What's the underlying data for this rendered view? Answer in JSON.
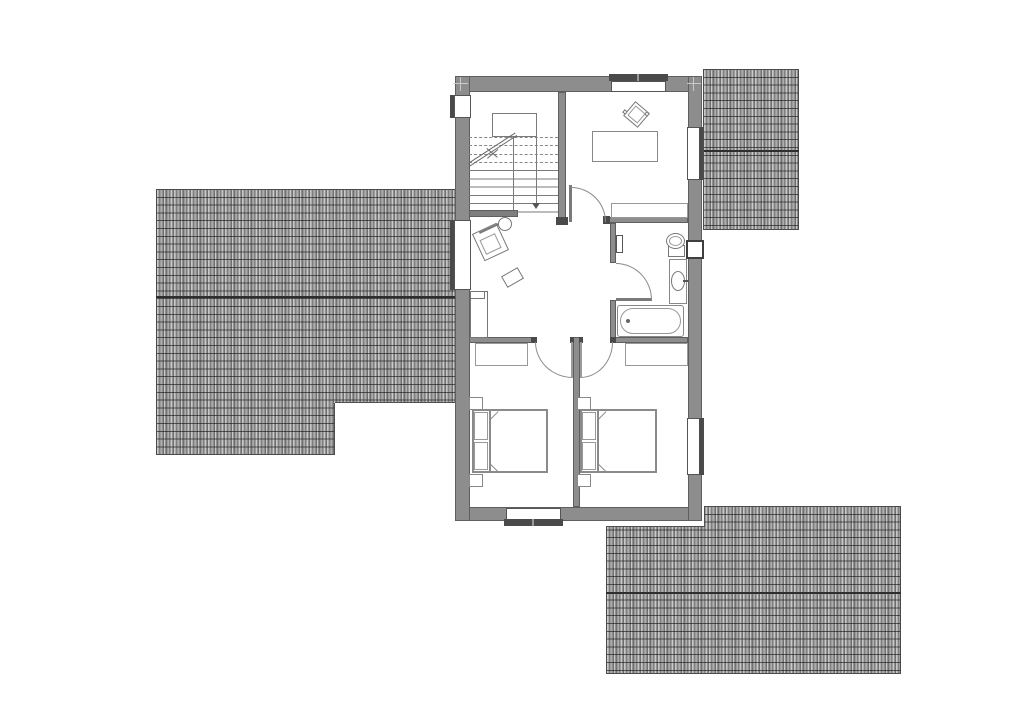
{
  "canvas": {
    "width": 1024,
    "height": 714
  },
  "colors": {
    "background": "#ffffff",
    "wall_fill": "#8d8d8d",
    "wall_edge": "#5f5f5f",
    "jamb_dark": "#4a4a4a",
    "furniture_line": "#7a7a7a",
    "roof_tile_dark": "#6f6f6f",
    "roof_tile_light": "#c9c9c9",
    "roof_ridge": "#2e2e2e"
  },
  "roofs": [
    {
      "n": "roof-left",
      "x": 156,
      "y": 189,
      "w": 300,
      "h": 266,
      "ridge": 107,
      "clip": "0px 0px, 300px 0px, 300px 214px, 179px 214px, 179px 266px, 0px 266px"
    },
    {
      "n": "roof-top-right",
      "x": 703,
      "y": 69,
      "w": 96,
      "h": 161,
      "ridge": 81,
      "clip": ""
    },
    {
      "n": "roof-bottom-right",
      "x": 606,
      "y": 506,
      "w": 295,
      "h": 168,
      "ridge": 86,
      "clip": "0px 21px, 99px 21px, 99px 0px, 295px 0px, 295px 168px, 0px 168px"
    }
  ],
  "shapes": [
    {
      "t": "rect",
      "n": "roof-left-step-edge-h",
      "x": 335,
      "y": 402,
      "w": 121,
      "h": 1,
      "f": "#4f4f4f"
    },
    {
      "t": "rect",
      "n": "roof-left-step-edge-v",
      "x": 334,
      "y": 403,
      "w": 1,
      "h": 52,
      "f": "#4f4f4f"
    },
    {
      "t": "rect",
      "n": "roof-br-step-edge-h",
      "x": 606,
      "y": 526,
      "w": 99,
      "h": 1,
      "f": "#4f4f4f"
    },
    {
      "t": "rect",
      "n": "roof-br-step-edge-v",
      "x": 704,
      "y": 506,
      "w": 1,
      "h": 21,
      "f": "#4f4f4f"
    },
    {
      "t": "rect",
      "n": "house-floor",
      "x": 455,
      "y": 76,
      "w": 247,
      "h": 445,
      "f": "#ffffff"
    },
    {
      "t": "rect",
      "n": "exterior-wall-top",
      "x": 455,
      "y": 76,
      "w": 247,
      "h": 16,
      "f": "#8d8d8d",
      "s": "#5f5f5f"
    },
    {
      "t": "rect",
      "n": "exterior-wall-bottom",
      "x": 455,
      "y": 507,
      "w": 247,
      "h": 14,
      "f": "#8d8d8d",
      "s": "#5f5f5f"
    },
    {
      "t": "rect",
      "n": "exterior-wall-left",
      "x": 455,
      "y": 76,
      "w": 15,
      "h": 445,
      "f": "#8d8d8d",
      "s": "#5f5f5f"
    },
    {
      "t": "rect",
      "n": "exterior-wall-right",
      "x": 688,
      "y": 76,
      "w": 14,
      "h": 445,
      "f": "#8d8d8d",
      "s": "#5f5f5f"
    },
    {
      "t": "rect",
      "n": "window-left-upper-frame-bar",
      "x": 450,
      "y": 95,
      "w": 5,
      "h": 23,
      "f": "#4a4a4a"
    },
    {
      "t": "rect",
      "n": "window-left-upper",
      "x": 454,
      "y": 95,
      "w": 17,
      "h": 23,
      "f": "#ffffff",
      "s": "#555555"
    },
    {
      "t": "rect",
      "n": "window-left-hall-frame-bar",
      "x": 450,
      "y": 220,
      "w": 5,
      "h": 70,
      "f": "#4a4a4a"
    },
    {
      "t": "rect",
      "n": "window-left-hall",
      "x": 454,
      "y": 220,
      "w": 17,
      "h": 70,
      "f": "#ffffff",
      "s": "#555555"
    },
    {
      "t": "rect",
      "n": "window-top-frame-bar",
      "x": 609,
      "y": 74,
      "w": 59,
      "h": 7,
      "f": "#4a4a4a"
    },
    {
      "t": "rect",
      "n": "window-top",
      "x": 611,
      "y": 81,
      "w": 55,
      "h": 11,
      "f": "#ffffff",
      "s": "#555555"
    },
    {
      "t": "rect",
      "n": "window-top-mullion-tick",
      "x": 637,
      "y": 74,
      "w": 2,
      "h": 7,
      "f": "#999999"
    },
    {
      "t": "rect",
      "n": "window-right-upper",
      "x": 687,
      "y": 127,
      "w": 15,
      "h": 53,
      "f": "#ffffff",
      "s": "#555555"
    },
    {
      "t": "rect",
      "n": "window-right-upper-frame-bar",
      "x": 699,
      "y": 127,
      "w": 5,
      "h": 53,
      "f": "#4a4a4a"
    },
    {
      "t": "rect",
      "n": "window-right-lower",
      "x": 687,
      "y": 418,
      "w": 15,
      "h": 57,
      "f": "#ffffff",
      "s": "#555555"
    },
    {
      "t": "rect",
      "n": "window-right-lower-frame-bar",
      "x": 699,
      "y": 418,
      "w": 5,
      "h": 57,
      "f": "#4a4a4a"
    },
    {
      "t": "rect",
      "n": "window-bottom",
      "x": 506,
      "y": 508,
      "w": 55,
      "h": 13,
      "f": "#ffffff",
      "s": "#555555"
    },
    {
      "t": "rect",
      "n": "window-bottom-frame-bar",
      "x": 504,
      "y": 519,
      "w": 59,
      "h": 7,
      "f": "#4a4a4a"
    },
    {
      "t": "rect",
      "n": "window-bottom-mullion-tick",
      "x": 532,
      "y": 519,
      "w": 2,
      "h": 7,
      "f": "#999999"
    },
    {
      "t": "rect",
      "n": "interior-wall-stairwell",
      "x": 558,
      "y": 92,
      "w": 8,
      "h": 126,
      "f": "#8d8d8d",
      "s": "#5f5f5f"
    },
    {
      "t": "rect",
      "n": "interior-wall-bedroom-tr",
      "x": 606,
      "y": 217,
      "w": 82,
      "h": 6,
      "f": "#8d8d8d",
      "s": "#5f5f5f"
    },
    {
      "t": "rect",
      "n": "interior-wall-bath-upper",
      "x": 610,
      "y": 223,
      "w": 6,
      "h": 40,
      "f": "#8d8d8d",
      "s": "#5f5f5f"
    },
    {
      "t": "rect",
      "n": "interior-wall-bath-lower",
      "x": 610,
      "y": 300,
      "w": 6,
      "h": 43,
      "f": "#8d8d8d",
      "s": "#5f5f5f"
    },
    {
      "t": "rect",
      "n": "interior-wall-bedrooms-left",
      "x": 469,
      "y": 337,
      "w": 66,
      "h": 6,
      "f": "#8d8d8d",
      "s": "#5f5f5f"
    },
    {
      "t": "rect",
      "n": "interior-wall-bedrooms-right",
      "x": 610,
      "y": 337,
      "w": 78,
      "h": 6,
      "f": "#8d8d8d",
      "s": "#5f5f5f"
    },
    {
      "t": "rect",
      "n": "interior-wall-center",
      "x": 573,
      "y": 337,
      "w": 7,
      "h": 170,
      "f": "#8d8d8d",
      "s": "#5f5f5f"
    },
    {
      "t": "rect",
      "n": "jamb-stairwell",
      "x": 556,
      "y": 217,
      "w": 12,
      "h": 8,
      "f": "#4a4a4a"
    },
    {
      "t": "rect",
      "n": "jamb-bedroom-tr-door",
      "x": 603,
      "y": 216,
      "w": 7,
      "h": 8,
      "f": "#4a4a4a"
    },
    {
      "t": "rect",
      "n": "jamb-bedroom-left-door",
      "x": 531,
      "y": 337,
      "w": 6,
      "h": 6,
      "f": "#4a4a4a"
    },
    {
      "t": "rect",
      "n": "jamb-bedroom-right-door",
      "x": 610,
      "y": 337,
      "w": 6,
      "h": 6,
      "f": "#4a4a4a"
    },
    {
      "t": "rect",
      "n": "jamb-center-left",
      "x": 570,
      "y": 337,
      "w": 4,
      "h": 6,
      "f": "#4a4a4a"
    },
    {
      "t": "rect",
      "n": "jamb-center-right",
      "x": 579,
      "y": 337,
      "w": 4,
      "h": 6,
      "f": "#4a4a4a"
    },
    {
      "t": "rect",
      "n": "door-leaf-bedroom-tr",
      "x": 569,
      "y": 185,
      "w": 3,
      "h": 37,
      "f": "#7a7a7a"
    },
    {
      "t": "arc",
      "n": "door-swing-bedroom-tr",
      "x": 571,
      "y": 187,
      "w": 35,
      "h": 35,
      "corner": "tr",
      "c": "#8a8a8a"
    },
    {
      "t": "rect",
      "n": "door-leaf-bathroom",
      "x": 616,
      "y": 298,
      "w": 36,
      "h": 3,
      "f": "#7a7a7a"
    },
    {
      "t": "arc",
      "n": "door-swing-bathroom",
      "x": 616,
      "y": 263,
      "w": 36,
      "h": 37,
      "corner": "tr",
      "c": "#8a8a8a"
    },
    {
      "t": "arc",
      "n": "door-swing-bedroom-left",
      "x": 535,
      "y": 342,
      "w": 38,
      "h": 36,
      "corner": "bl",
      "c": "#8a8a8a"
    },
    {
      "t": "arc",
      "n": "door-swing-bedroom-right",
      "x": 580,
      "y": 342,
      "w": 33,
      "h": 36,
      "corner": "br",
      "c": "#8a8a8a"
    },
    {
      "t": "rect",
      "n": "door-leaf-bedroom-left",
      "x": 571,
      "y": 342,
      "w": 2,
      "h": 36,
      "f": "#9a9a9a"
    },
    {
      "t": "rect",
      "n": "door-leaf-bedroom-right",
      "x": 580,
      "y": 342,
      "w": 2,
      "h": 36,
      "f": "#9a9a9a"
    },
    {
      "t": "rect",
      "n": "bathroom-door-side-block",
      "x": 616,
      "y": 235,
      "w": 7,
      "h": 18,
      "f": "#ffffff",
      "s": "#555555",
      "sw": 1.5
    },
    {
      "t": "rect",
      "n": "staircase-landing",
      "x": 492,
      "y": 113,
      "w": 45,
      "h": 24,
      "f": "#ffffff",
      "s": "#7a7a7a"
    },
    {
      "t": "line",
      "n": "stair-tread-dashed-1",
      "x": 469,
      "y": 137,
      "len": 89,
      "dashed": true,
      "c": "#888888"
    },
    {
      "t": "line",
      "n": "stair-tread-dashed-2",
      "x": 469,
      "y": 145,
      "len": 89,
      "dashed": true,
      "c": "#888888"
    },
    {
      "t": "line",
      "n": "stair-tread-dashed-3",
      "x": 469,
      "y": 154,
      "len": 89,
      "dashed": true,
      "c": "#888888"
    },
    {
      "t": "line",
      "n": "stair-tread-dashed-4",
      "x": 469,
      "y": 162,
      "len": 89,
      "dashed": true,
      "c": "#888888"
    },
    {
      "t": "treads",
      "n": "stair-treads-solid",
      "x": 469,
      "y": 170,
      "w": 89,
      "h": 43,
      "c": "#7a7a7a"
    },
    {
      "t": "rect",
      "n": "stair-flight-divider",
      "x": 513,
      "y": 137,
      "w": 1,
      "h": 75,
      "f": "#7a7a7a"
    },
    {
      "t": "rect",
      "n": "stair-walk-line",
      "x": 536,
      "y": 137,
      "w": 1,
      "h": 66,
      "f": "#7a7a7a"
    },
    {
      "t": "tri",
      "n": "stair-walk-arrow",
      "x": 532,
      "y": 203,
      "size": 4,
      "size2": 6,
      "c": "#555555"
    },
    {
      "t": "dline",
      "n": "stair-break-line",
      "x": 468,
      "y": 163,
      "len": 56,
      "a": -33,
      "c": "#6a6a6a"
    },
    {
      "t": "line",
      "n": "stair-break-x-1",
      "x": 487,
      "y": 158,
      "len": 14,
      "a": -40,
      "c": "#6a6a6a"
    },
    {
      "t": "line",
      "n": "stair-break-x-2",
      "x": 487,
      "y": 148,
      "len": 14,
      "a": 40,
      "c": "#6a6a6a"
    },
    {
      "t": "rect",
      "n": "stair-bottom-guard-wall",
      "x": 469,
      "y": 210,
      "w": 49,
      "h": 7,
      "f": "#7e7e7e",
      "s": "#5f5f5f"
    },
    {
      "t": "rect",
      "n": "hall-armchair",
      "x": 477,
      "y": 227,
      "w": 27,
      "h": 30,
      "r": -25,
      "s": "#777777",
      "sw": 1.5
    },
    {
      "t": "rect",
      "n": "hall-armchair-seat",
      "x": 482,
      "y": 236,
      "w": 17,
      "h": 16,
      "r": -25,
      "s": "#999999"
    },
    {
      "t": "line",
      "n": "hall-armchair-back",
      "x": 479,
      "y": 232,
      "len": 28,
      "a": -25,
      "th": 2,
      "c": "#777777"
    },
    {
      "t": "ellipse",
      "n": "hall-side-table",
      "x": 498,
      "y": 217,
      "w": 14,
      "h": 14,
      "s": "#777777"
    },
    {
      "t": "rect",
      "n": "hall-stool",
      "x": 503,
      "y": 271,
      "w": 19,
      "h": 13,
      "r": -30,
      "s": "#777777"
    },
    {
      "t": "rect",
      "n": "hall-cabinet",
      "x": 470,
      "y": 291,
      "w": 18,
      "h": 47,
      "s": "#777777"
    },
    {
      "t": "rect",
      "n": "hall-cabinet-top-section",
      "x": 470,
      "y": 291,
      "w": 15,
      "h": 8,
      "s": "#777777"
    },
    {
      "t": "rect",
      "n": "bedroom-tr-desk",
      "x": 592,
      "y": 131,
      "w": 66,
      "h": 31,
      "s": "#888888",
      "sw": 1.5
    },
    {
      "t": "rect",
      "n": "bedroom-tr-desk-chair",
      "x": 627,
      "y": 105,
      "w": 19,
      "h": 19,
      "r": 40,
      "s": "#777777",
      "sw": 1.5
    },
    {
      "t": "rect",
      "n": "bedroom-tr-desk-chair-seat",
      "x": 630,
      "y": 108,
      "w": 13,
      "h": 13,
      "r": 40,
      "s": "#999999"
    },
    {
      "t": "rect",
      "n": "bedroom-tr-chair-armrest-1",
      "x": 623,
      "y": 110,
      "w": 4,
      "h": 4,
      "r": 40,
      "s": "#777777"
    },
    {
      "t": "rect",
      "n": "bedroom-tr-chair-armrest-2",
      "x": 645,
      "y": 112,
      "w": 4,
      "h": 4,
      "r": 40,
      "s": "#777777"
    },
    {
      "t": "rect",
      "n": "bedroom-tr-shelf",
      "x": 611,
      "y": 203,
      "w": 77,
      "h": 15,
      "s": "#999999"
    },
    {
      "t": "rect",
      "n": "chimney-block",
      "x": 686,
      "y": 240,
      "w": 18,
      "h": 19,
      "f": "#ffffff",
      "s": "#3f3f3f",
      "sw": 2
    },
    {
      "t": "rect",
      "n": "toilet-cistern",
      "x": 668,
      "y": 245,
      "w": 17,
      "h": 12,
      "s": "#777777"
    },
    {
      "t": "ellipse",
      "n": "toilet-bowl",
      "x": 666,
      "y": 233,
      "w": 19,
      "h": 16,
      "f": "#ffffff",
      "s": "#777777"
    },
    {
      "t": "ellipse",
      "n": "toilet-bowl-inner",
      "x": 669,
      "y": 236,
      "w": 13,
      "h": 10,
      "s": "#999999"
    },
    {
      "t": "rect",
      "n": "bathroom-vanity",
      "x": 669,
      "y": 259,
      "w": 18,
      "h": 45,
      "s": "#888888"
    },
    {
      "t": "ellipse",
      "n": "bathroom-sink",
      "x": 671,
      "y": 271,
      "w": 14,
      "h": 20,
      "s": "#777777"
    },
    {
      "t": "rect",
      "n": "sink-tap",
      "x": 683,
      "y": 280,
      "w": 6,
      "h": 2,
      "f": "#555555"
    },
    {
      "t": "rect",
      "n": "bathtub",
      "x": 617,
      "y": 305,
      "w": 67,
      "h": 32,
      "s": "#888888",
      "sw": 1.5,
      "rad": 3
    },
    {
      "t": "rect",
      "n": "bathtub-inner",
      "x": 620,
      "y": 308,
      "w": 61,
      "h": 26,
      "s": "#999999",
      "rad": 13
    },
    {
      "t": "ellipse",
      "n": "bathtub-faucet",
      "x": 626,
      "y": 319,
      "w": 4,
      "h": 4,
      "f": "#666666"
    },
    {
      "t": "rect",
      "n": "bedroom-bl-shelf",
      "x": 475,
      "y": 343,
      "w": 53,
      "h": 23,
      "s": "#999999"
    },
    {
      "t": "rect",
      "n": "bedroom-br-shelf",
      "x": 625,
      "y": 343,
      "w": 63,
      "h": 23,
      "s": "#999999"
    },
    {
      "t": "rect",
      "n": "bed-left-frame",
      "x": 472,
      "y": 409,
      "w": 76,
      "h": 64,
      "s": "#8a8a8a",
      "sw": 2
    },
    {
      "t": "rect",
      "n": "bed-left-pillow-1",
      "x": 474,
      "y": 412,
      "w": 14,
      "h": 28,
      "s": "#999999"
    },
    {
      "t": "rect",
      "n": "bed-left-pillow-2",
      "x": 474,
      "y": 442,
      "w": 14,
      "h": 28,
      "s": "#999999"
    },
    {
      "t": "rect",
      "n": "bed-left-mattress-line",
      "x": 489,
      "y": 411,
      "w": 2,
      "h": 60,
      "f": "#8a8a8a"
    },
    {
      "t": "line",
      "n": "bed-left-fold-mark-1",
      "x": 490,
      "y": 419,
      "len": 11,
      "a": -45,
      "c": "#8a8a8a"
    },
    {
      "t": "line",
      "n": "bed-left-fold-mark-2",
      "x": 490,
      "y": 463,
      "len": 11,
      "a": 45,
      "c": "#8a8a8a"
    },
    {
      "t": "rect",
      "n": "bed-left-nightstand-1",
      "x": 469,
      "y": 397,
      "w": 14,
      "h": 13,
      "s": "#888888"
    },
    {
      "t": "rect",
      "n": "bed-left-nightstand-2",
      "x": 469,
      "y": 474,
      "w": 14,
      "h": 13,
      "s": "#888888"
    },
    {
      "t": "rect",
      "n": "bed-right-frame",
      "x": 580,
      "y": 409,
      "w": 77,
      "h": 64,
      "s": "#8a8a8a",
      "sw": 2
    },
    {
      "t": "rect",
      "n": "bed-right-pillow-1",
      "x": 582,
      "y": 412,
      "w": 14,
      "h": 28,
      "s": "#999999"
    },
    {
      "t": "rect",
      "n": "bed-right-pillow-2",
      "x": 582,
      "y": 442,
      "w": 14,
      "h": 28,
      "s": "#999999"
    },
    {
      "t": "rect",
      "n": "bed-right-mattress-line",
      "x": 597,
      "y": 411,
      "w": 2,
      "h": 60,
      "f": "#8a8a8a"
    },
    {
      "t": "line",
      "n": "bed-right-fold-mark-1",
      "x": 598,
      "y": 419,
      "len": 11,
      "a": -45,
      "c": "#8a8a8a"
    },
    {
      "t": "line",
      "n": "bed-right-fold-mark-2",
      "x": 598,
      "y": 463,
      "len": 11,
      "a": 45,
      "c": "#8a8a8a"
    },
    {
      "t": "rect",
      "n": "bed-right-nightstand-1",
      "x": 577,
      "y": 397,
      "w": 14,
      "h": 13,
      "s": "#888888"
    },
    {
      "t": "rect",
      "n": "bed-right-nightstand-2",
      "x": 577,
      "y": 474,
      "w": 14,
      "h": 13,
      "s": "#888888"
    },
    {
      "t": "rect",
      "n": "survey-cross-1-h",
      "x": 454,
      "y": 83,
      "w": 14,
      "h": 1,
      "f": "#c9c9c9"
    },
    {
      "t": "rect",
      "n": "survey-cross-1-v",
      "x": 460,
      "y": 77,
      "w": 1,
      "h": 14,
      "f": "#c9c9c9"
    },
    {
      "t": "rect",
      "n": "survey-cross-2-h",
      "x": 687,
      "y": 83,
      "w": 14,
      "h": 1,
      "f": "#c9c9c9"
    },
    {
      "t": "rect",
      "n": "survey-cross-2-v",
      "x": 693,
      "y": 77,
      "w": 1,
      "h": 14,
      "f": "#c9c9c9"
    }
  ]
}
